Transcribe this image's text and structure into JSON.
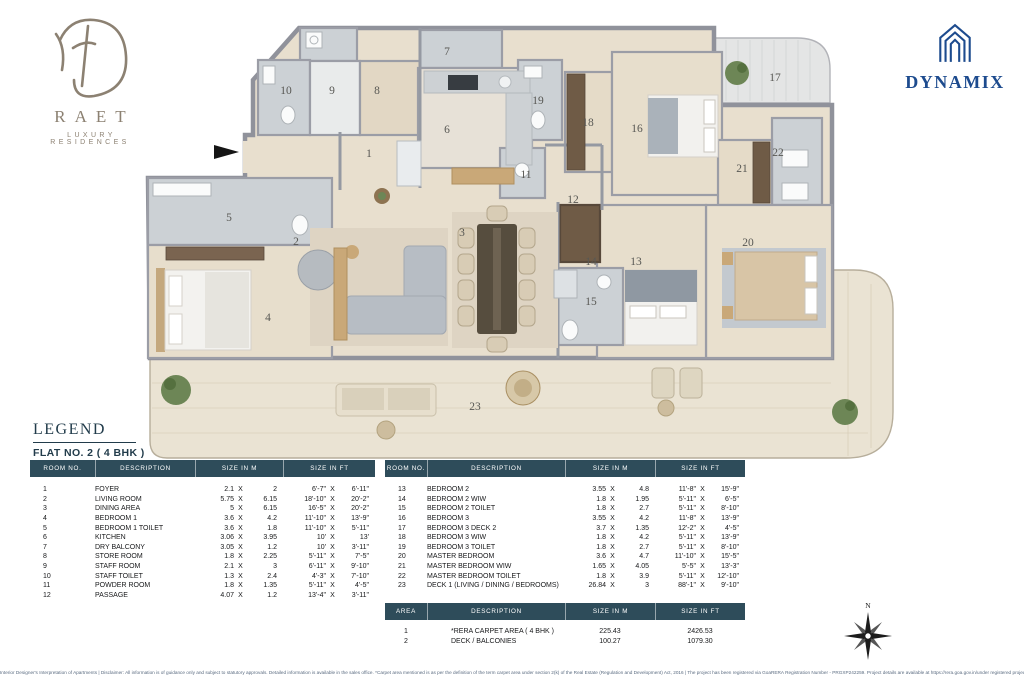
{
  "branding": {
    "raet_name": "RAET",
    "raet_tagline": "LUXURY RESIDENCES",
    "dynamix_name": "DYNAMIX"
  },
  "legend": {
    "title": "LEGEND",
    "subtitle": "FLAT NO. 2  ( 4 BHK )",
    "headers": {
      "no": "ROOM NO.",
      "desc": "DESCRIPTION",
      "m": "SIZE IN M",
      "ft": "SIZE IN FT"
    },
    "x_sep": "X",
    "rows_left": [
      {
        "no": "1",
        "desc": "FOYER",
        "m1": "2.1",
        "m2": "2",
        "f1": "6'-7\"",
        "f2": "6'-11\""
      },
      {
        "no": "2",
        "desc": "LIVING ROOM",
        "m1": "5.75",
        "m2": "6.15",
        "f1": "18'-10\"",
        "f2": "20'-2\""
      },
      {
        "no": "3",
        "desc": "DINING AREA",
        "m1": "5",
        "m2": "6.15",
        "f1": "16'-5\"",
        "f2": "20'-2\""
      },
      {
        "no": "4",
        "desc": "BEDROOM 1",
        "m1": "3.6",
        "m2": "4.2",
        "f1": "11'-10\"",
        "f2": "13'-9\""
      },
      {
        "no": "5",
        "desc": "BEDROOM 1 TOILET",
        "m1": "3.6",
        "m2": "1.8",
        "f1": "11'-10\"",
        "f2": "5'-11\""
      },
      {
        "no": "6",
        "desc": "KITCHEN",
        "m1": "3.06",
        "m2": "3.95",
        "f1": "10'",
        "f2": "13'"
      },
      {
        "no": "7",
        "desc": "DRY BALCONY",
        "m1": "3.05",
        "m2": "1.2",
        "f1": "10'",
        "f2": "3'-11\""
      },
      {
        "no": "8",
        "desc": "STORE ROOM",
        "m1": "1.8",
        "m2": "2.25",
        "f1": "5'-11\"",
        "f2": "7'-5\""
      },
      {
        "no": "9",
        "desc": "STAFF ROOM",
        "m1": "2.1",
        "m2": "3",
        "f1": "6'-11\"",
        "f2": "9'-10\""
      },
      {
        "no": "10",
        "desc": "STAFF TOILET",
        "m1": "1.3",
        "m2": "2.4",
        "f1": "4'-3\"",
        "f2": "7'-10\""
      },
      {
        "no": "11",
        "desc": "POWDER ROOM",
        "m1": "1.8",
        "m2": "1.35",
        "f1": "5'-11\"",
        "f2": "4'-5\""
      },
      {
        "no": "12",
        "desc": "PASSAGE",
        "m1": "4.07",
        "m2": "1.2",
        "f1": "13'-4\"",
        "f2": "3'-11\""
      }
    ],
    "rows_right": [
      {
        "no": "13",
        "desc": "BEDROOM 2",
        "m1": "3.55",
        "m2": "4.8",
        "f1": "11'-8\"",
        "f2": "15'-9\""
      },
      {
        "no": "14",
        "desc": "BEDROOM 2 WIW",
        "m1": "1.8",
        "m2": "1.95",
        "f1": "5'-11\"",
        "f2": "6'-5\""
      },
      {
        "no": "15",
        "desc": "BEDROOM 2 TOILET",
        "m1": "1.8",
        "m2": "2.7",
        "f1": "5'-11\"",
        "f2": "8'-10\""
      },
      {
        "no": "16",
        "desc": "BEDROOM 3",
        "m1": "3.55",
        "m2": "4.2",
        "f1": "11'-8\"",
        "f2": "13'-9\""
      },
      {
        "no": "17",
        "desc": "BEDROOM 3  DECK 2",
        "m1": "3.7",
        "m2": "1.35",
        "f1": "12'-2\"",
        "f2": "4'-5\""
      },
      {
        "no": "18",
        "desc": "BEDROOM 3 WIW",
        "m1": "1.8",
        "m2": "4.2",
        "f1": "5'-11\"",
        "f2": "13'-9\""
      },
      {
        "no": "19",
        "desc": "BEDROOM 3 TOILET",
        "m1": "1.8",
        "m2": "2.7",
        "f1": "5'-11\"",
        "f2": "8'-10\""
      },
      {
        "no": "20",
        "desc": "MASTER BEDROOM",
        "m1": "3.6",
        "m2": "4.7",
        "f1": "11'-10\"",
        "f2": "15'-5\""
      },
      {
        "no": "21",
        "desc": "MASTER BEDROOM WIW",
        "m1": "1.65",
        "m2": "4.05",
        "f1": "5'-5\"",
        "f2": "13'-3\""
      },
      {
        "no": "22",
        "desc": "MASTER BEDROOM TOILET",
        "m1": "1.8",
        "m2": "3.9",
        "f1": "5'-11\"",
        "f2": "12'-10\""
      },
      {
        "no": "23",
        "desc": "DECK 1 (LIVING / DINING / BEDROOMS)",
        "m1": "26.84",
        "m2": "3",
        "f1": "88'-1\"",
        "f2": "9'-10\""
      }
    ],
    "area_table": {
      "headers": {
        "no": "AREA",
        "desc": "DESCRIPTION",
        "m": "SIZE IN M",
        "ft": "SIZE IN FT"
      },
      "rows": [
        {
          "no": "1",
          "desc": "*RERA CARPET AREA ( 4 BHK )",
          "m": "225.43",
          "ft": "2426.53"
        },
        {
          "no": "2",
          "desc": "DECK / BALCONIES",
          "m": "100.27",
          "ft": "1079.30"
        }
      ]
    }
  },
  "plan": {
    "labels": [
      "1",
      "2",
      "3",
      "4",
      "5",
      "6",
      "7",
      "8",
      "9",
      "10",
      "11",
      "12",
      "13",
      "14",
      "15",
      "16",
      "17",
      "18",
      "19",
      "20",
      "21",
      "22",
      "23"
    ]
  },
  "compass": {
    "north": "N"
  },
  "footer": {
    "disclaimer": "Interior Designer's Interpretation of Apartments | Disclaimer: All information is of guidance only and subject to statutory approvals. Detailed information is available in the sales office. *Carpet area mentioned is as per the definition of the term carpet area under section 2(k) of the Real Estate (Regulation and Development) Act, 2016 | The project has been registered via GoaRERA Registration Number - PRGXP242259. Project details are available at https://rera.goa.gov.in/under registered project"
  }
}
